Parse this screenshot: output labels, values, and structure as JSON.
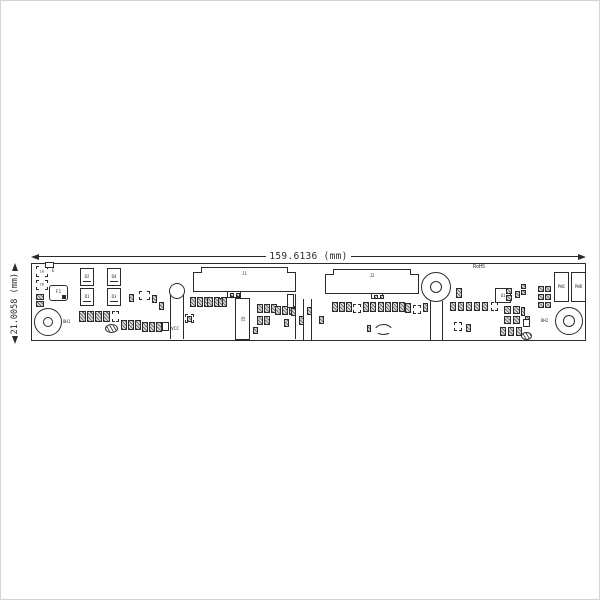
{
  "dimensions": {
    "width_label": "159.6136 (mm)",
    "height_label": "21.0058 (mm)"
  },
  "colors": {
    "ink": "#2b2b2b",
    "frame": "#d4d4d4",
    "pad_fill": "#8f8f8f"
  },
  "board": {
    "x": 30,
    "y": 262,
    "width": 555,
    "height": 78
  },
  "components": [
    {
      "name": "ref-bracket-L6",
      "type": "bracket",
      "x": 35,
      "y": 265,
      "w": 12,
      "h": 11,
      "label": "L6"
    },
    {
      "name": "pad-E",
      "type": "rect",
      "x": 44,
      "y": 261,
      "w": 9,
      "h": 6
    },
    {
      "name": "ref-text-E",
      "type": "text",
      "x": 51,
      "y": 268,
      "label": "E",
      "size": 4
    },
    {
      "name": "ref-bracket-C6",
      "type": "bracket",
      "x": 35,
      "y": 279,
      "w": 12,
      "h": 10,
      "label": "C6"
    },
    {
      "name": "fuse-F1",
      "type": "fuse",
      "x": 48,
      "y": 284,
      "w": 19,
      "h": 16,
      "label": "F1"
    },
    {
      "name": "cap-pads",
      "type": "padcol",
      "x": 35,
      "y": 293,
      "w": 8,
      "h": 6,
      "count": 2,
      "gap": 1
    },
    {
      "name": "hole-BH1",
      "type": "hole",
      "cx": 47,
      "cy": 321,
      "r": 14,
      "r2": 5,
      "label": "BH1",
      "labelSide": "right"
    },
    {
      "name": "diode-D2",
      "type": "diode",
      "x": 79,
      "y": 267,
      "w": 14,
      "h": 18,
      "label": "D2"
    },
    {
      "name": "diode-D1",
      "type": "diode",
      "x": 79,
      "y": 287,
      "w": 14,
      "h": 18,
      "label": "D1"
    },
    {
      "name": "diode-D4",
      "type": "diode",
      "x": 106,
      "y": 267,
      "w": 14,
      "h": 18,
      "label": "D4"
    },
    {
      "name": "diode-D3",
      "type": "diode",
      "x": 106,
      "y": 287,
      "w": 14,
      "h": 18,
      "label": "D3"
    },
    {
      "name": "res-row-1",
      "type": "padrow",
      "x": 78,
      "y": 310,
      "w": 7,
      "h": 11,
      "count": 4,
      "gap": 1
    },
    {
      "name": "ref-bracket-r1",
      "type": "bracket",
      "x": 111,
      "y": 310,
      "w": 7,
      "h": 11
    },
    {
      "name": "bead-1",
      "type": "coil",
      "x": 104,
      "y": 323,
      "w": 13,
      "h": 9
    },
    {
      "name": "res-row-2",
      "type": "padrow",
      "x": 120,
      "y": 319,
      "w": 6,
      "h": 10,
      "count": 3,
      "gap": 1
    },
    {
      "name": "res-row-3",
      "type": "padrow",
      "x": 141,
      "y": 321,
      "w": 6,
      "h": 10,
      "count": 3,
      "gap": 1
    },
    {
      "name": "sq-comp-1",
      "type": "rect",
      "x": 161,
      "y": 321,
      "w": 7,
      "h": 9
    },
    {
      "name": "ref-bracket-C5",
      "type": "bracket",
      "x": 138,
      "y": 290,
      "w": 11,
      "h": 9
    },
    {
      "name": "pad-1",
      "type": "pad",
      "x": 128,
      "y": 293,
      "w": 5,
      "h": 8
    },
    {
      "name": "pad-2",
      "type": "pad",
      "x": 151,
      "y": 294,
      "w": 5,
      "h": 8
    },
    {
      "name": "pad-3",
      "type": "pad",
      "x": 158,
      "y": 301,
      "w": 5,
      "h": 8
    },
    {
      "name": "testpost-VCC",
      "type": "post",
      "cx": 176,
      "cy": 290,
      "r": 8,
      "legTo": 338,
      "label": "VCC"
    },
    {
      "name": "ref-bracket-tp",
      "type": "bracket",
      "x": 184,
      "y": 313,
      "w": 9,
      "h": 9
    },
    {
      "name": "pad-4",
      "type": "pad",
      "x": 186,
      "y": 315,
      "w": 5,
      "h": 6
    },
    {
      "name": "connector-J1",
      "type": "connector",
      "x": 192,
      "y": 266,
      "w": 103,
      "h": 25,
      "label": "J1"
    },
    {
      "name": "connector-J1-tab",
      "type": "tab",
      "x": 226,
      "y": 290,
      "w": 14,
      "h": 7
    },
    {
      "name": "pin1-dot",
      "type": "dot",
      "x": 240,
      "y": 299,
      "w": 3,
      "h": 3
    },
    {
      "name": "res-row-4",
      "type": "padrow",
      "x": 189,
      "y": 296,
      "w": 6,
      "h": 10,
      "count": 3,
      "gap": 1
    },
    {
      "name": "res-row-5",
      "type": "padrow",
      "x": 206,
      "y": 296,
      "w": 6,
      "h": 10,
      "count": 3,
      "gap": 1
    },
    {
      "name": "pad-5",
      "type": "pad",
      "x": 217,
      "y": 297,
      "w": 5,
      "h": 9
    },
    {
      "name": "ic-U2",
      "type": "ic",
      "x": 234,
      "y": 297,
      "w": 15,
      "h": 42,
      "label": "U2",
      "rot": true
    },
    {
      "name": "res-row-6",
      "type": "padrow",
      "x": 256,
      "y": 303,
      "w": 6,
      "h": 9,
      "count": 3,
      "gap": 1
    },
    {
      "name": "res-row-7",
      "type": "padrow",
      "x": 256,
      "y": 315,
      "w": 6,
      "h": 9,
      "count": 2,
      "gap": 1
    },
    {
      "name": "res-row-8",
      "type": "padrow",
      "x": 274,
      "y": 305,
      "w": 6,
      "h": 9,
      "count": 3,
      "gap": 1
    },
    {
      "name": "pad-6",
      "type": "pad",
      "x": 290,
      "y": 307,
      "w": 5,
      "h": 8
    },
    {
      "name": "pad-7",
      "type": "pad",
      "x": 283,
      "y": 318,
      "w": 5,
      "h": 8
    },
    {
      "name": "pad-8",
      "type": "pad",
      "x": 252,
      "y": 326,
      "w": 5,
      "h": 7
    },
    {
      "name": "silk-rect-1",
      "type": "rect",
      "x": 286,
      "y": 293,
      "w": 7,
      "h": 14
    },
    {
      "name": "silk-line-1",
      "type": "line",
      "x": 294,
      "y": 293,
      "w": 1,
      "h": 45
    },
    {
      "name": "silk-line-2",
      "type": "line",
      "x": 302,
      "y": 298,
      "w": 1,
      "h": 41
    },
    {
      "name": "silk-line-3",
      "type": "line",
      "x": 310,
      "y": 298,
      "w": 1,
      "h": 41
    },
    {
      "name": "pad-9",
      "type": "pad",
      "x": 298,
      "y": 315,
      "w": 5,
      "h": 9
    },
    {
      "name": "pad-10",
      "type": "pad",
      "x": 306,
      "y": 306,
      "w": 5,
      "h": 8
    },
    {
      "name": "pad-11",
      "type": "pad",
      "x": 318,
      "y": 315,
      "w": 5,
      "h": 8
    },
    {
      "name": "connector-J2",
      "type": "connector",
      "x": 324,
      "y": 268,
      "w": 94,
      "h": 25,
      "label": "J2"
    },
    {
      "name": "connector-J2-tab",
      "type": "tab",
      "x": 370,
      "y": 292,
      "w": 12,
      "h": 6
    },
    {
      "name": "res-row-9",
      "type": "padrow",
      "x": 331,
      "y": 301,
      "w": 6,
      "h": 10,
      "count": 3,
      "gap": 1
    },
    {
      "name": "ref-bracket-b1",
      "type": "bracket",
      "x": 352,
      "y": 303,
      "w": 8,
      "h": 9
    },
    {
      "name": "res-row-10",
      "type": "padrow",
      "x": 362,
      "y": 301,
      "w": 6,
      "h": 10,
      "count": 2,
      "gap": 1
    },
    {
      "name": "res-row-11",
      "type": "padrow",
      "x": 377,
      "y": 301,
      "w": 6,
      "h": 10,
      "count": 4,
      "gap": 1
    },
    {
      "name": "pad-12",
      "type": "pad",
      "x": 404,
      "y": 302,
      "w": 6,
      "h": 10
    },
    {
      "name": "ref-bracket-b2",
      "type": "bracket",
      "x": 412,
      "y": 304,
      "w": 8,
      "h": 9
    },
    {
      "name": "pad-13",
      "type": "pad",
      "x": 422,
      "y": 302,
      "w": 5,
      "h": 9
    },
    {
      "name": "pad-14",
      "type": "pad",
      "x": 366,
      "y": 324,
      "w": 4,
      "h": 7
    },
    {
      "name": "jumper-arcs",
      "type": "arcs",
      "x": 374,
      "y": 323,
      "w": 17,
      "h": 11
    },
    {
      "name": "hole-mid",
      "type": "hole",
      "cx": 435,
      "cy": 286,
      "r": 15,
      "r2": 6
    },
    {
      "name": "mid-leg-1",
      "type": "line",
      "x": 429,
      "y": 300,
      "w": 1,
      "h": 39
    },
    {
      "name": "mid-leg-2",
      "type": "line",
      "x": 441,
      "y": 300,
      "w": 1,
      "h": 39
    },
    {
      "name": "rohs-text",
      "type": "text",
      "x": 472,
      "y": 264,
      "label": "RoHS",
      "size": 5
    },
    {
      "name": "pad-15",
      "type": "pad",
      "x": 455,
      "y": 287,
      "w": 6,
      "h": 10
    },
    {
      "name": "res-row-12",
      "type": "padrow",
      "x": 449,
      "y": 301,
      "w": 6,
      "h": 9,
      "count": 5,
      "gap": 2
    },
    {
      "name": "ref-bracket-b3",
      "type": "bracket",
      "x": 490,
      "y": 301,
      "w": 7,
      "h": 9
    },
    {
      "name": "ref-bracket-b4",
      "type": "bracket",
      "x": 453,
      "y": 321,
      "w": 8,
      "h": 9
    },
    {
      "name": "pad-16",
      "type": "pad",
      "x": 465,
      "y": 323,
      "w": 5,
      "h": 8
    },
    {
      "name": "ic-U1",
      "type": "ic",
      "x": 494,
      "y": 287,
      "w": 16,
      "h": 15,
      "label": "U1",
      "mark": true
    },
    {
      "name": "padcol-1",
      "type": "padcol",
      "x": 505,
      "y": 287,
      "w": 6,
      "h": 6,
      "count": 2,
      "gap": 1
    },
    {
      "name": "pad-17",
      "type": "pad",
      "x": 514,
      "y": 290,
      "w": 5,
      "h": 7
    },
    {
      "name": "grid-row-1",
      "type": "padrow",
      "x": 503,
      "y": 305,
      "w": 7,
      "h": 8,
      "count": 2,
      "gap": 2
    },
    {
      "name": "grid-row-2",
      "type": "padrow",
      "x": 503,
      "y": 315,
      "w": 7,
      "h": 8,
      "count": 2,
      "gap": 2
    },
    {
      "name": "pad-18",
      "type": "pad",
      "x": 524,
      "y": 315,
      "w": 5,
      "h": 9
    },
    {
      "name": "res-row-13",
      "type": "padrow",
      "x": 499,
      "y": 326,
      "w": 6,
      "h": 9,
      "count": 3,
      "gap": 2
    },
    {
      "name": "bead-2",
      "type": "coil",
      "x": 520,
      "y": 331,
      "w": 11,
      "h": 8
    },
    {
      "name": "padcol-2",
      "type": "padcol",
      "x": 520,
      "y": 283,
      "w": 5,
      "h": 5,
      "count": 2,
      "gap": 1
    },
    {
      "name": "grid-row-3",
      "type": "padrow",
      "x": 537,
      "y": 285,
      "w": 6,
      "h": 6,
      "count": 2,
      "gap": 1
    },
    {
      "name": "grid-row-4",
      "type": "padrow",
      "x": 537,
      "y": 293,
      "w": 6,
      "h": 6,
      "count": 2,
      "gap": 1
    },
    {
      "name": "grid-row-5",
      "type": "padrow",
      "x": 537,
      "y": 301,
      "w": 6,
      "h": 6,
      "count": 2,
      "gap": 1
    },
    {
      "name": "pad-19",
      "type": "pad",
      "x": 520,
      "y": 306,
      "w": 4,
      "h": 9
    },
    {
      "name": "sq-comp-2",
      "type": "rect",
      "x": 522,
      "y": 318,
      "w": 7,
      "h": 8
    },
    {
      "name": "hole-BH2",
      "type": "hole",
      "cx": 568,
      "cy": 320,
      "r": 14,
      "r2": 6,
      "label": "BH2",
      "labelSide": "left"
    },
    {
      "name": "connector-PWC",
      "type": "ic",
      "x": 553,
      "y": 271,
      "w": 15,
      "h": 30,
      "label": "PWC"
    },
    {
      "name": "connector-PWD",
      "type": "ic",
      "x": 570,
      "y": 271,
      "w": 15,
      "h": 30,
      "label": "PWD"
    }
  ]
}
